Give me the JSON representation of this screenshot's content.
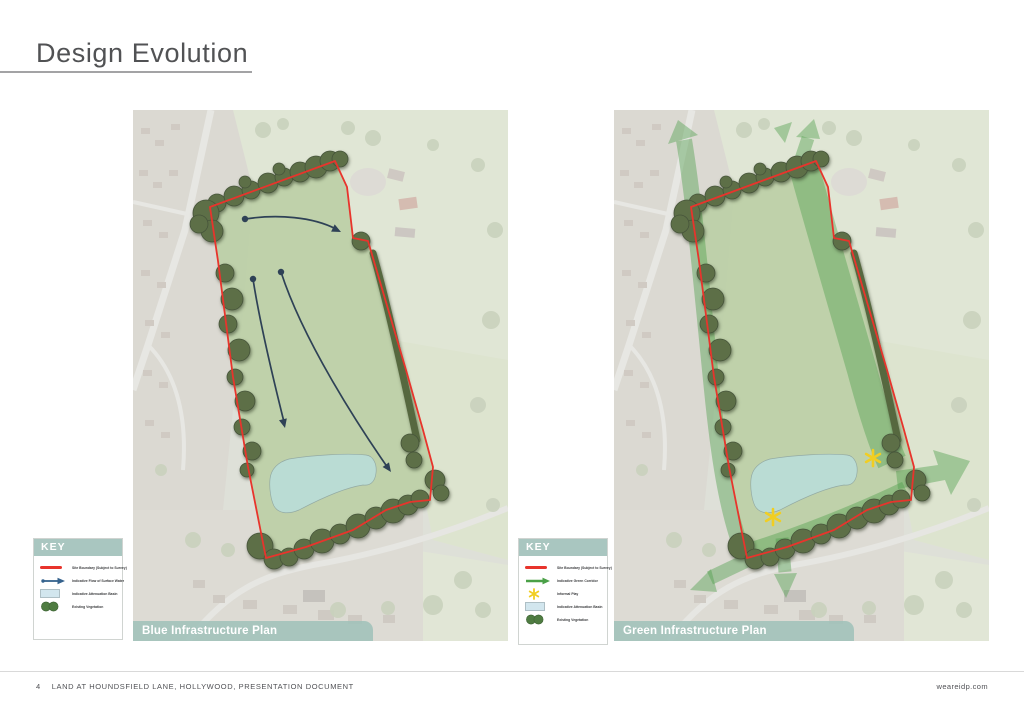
{
  "page": {
    "title": "Design Evolution",
    "footer": {
      "page_number": "4",
      "document_title": "LAND AT HOUNDSFIELD LANE, HOLLYWOOD, PRESENTATION DOCUMENT",
      "website": "weareidp.com"
    }
  },
  "plans": {
    "blue": {
      "caption": "Blue Infrastructure Plan",
      "legend": {
        "header": "KEY",
        "rows": [
          {
            "symbol": "site-boundary-line",
            "label": "Site Boundary (Subject to Survey)"
          },
          {
            "symbol": "surface-water-flow-arrow",
            "label": "Indicative Flow of Surface Water"
          },
          {
            "symbol": "attenuation-basin-swatch",
            "label": "Indicative Attenuation Basin"
          },
          {
            "symbol": "existing-vegetation-circles",
            "label": "Existing Vegetation"
          }
        ]
      }
    },
    "green": {
      "caption": "Green Infrastructure Plan",
      "legend": {
        "header": "KEY",
        "rows": [
          {
            "symbol": "site-boundary-line",
            "label": "Site Boundary (Subject to Survey)"
          },
          {
            "symbol": "green-corridor-arrow",
            "label": "Indicative Green Corridor"
          },
          {
            "symbol": "informal-play-star",
            "label": "Informal Play"
          },
          {
            "symbol": "attenuation-basin-swatch",
            "label": "Indicative Attenuation Basin"
          },
          {
            "symbol": "existing-vegetation-circles",
            "label": "Existing Vegetation"
          }
        ]
      }
    }
  },
  "colors": {
    "site_boundary_red": "#e8342c",
    "water_flow_navy": "#2e4156",
    "green_corridor_green": "#4c9d49",
    "attenuation_basin_blue": "#b9dcd6",
    "existing_vegetation_green": "#5d6f47",
    "informal_play_yellow": "#f1ce22",
    "key_header_teal": "#a9c6c0",
    "caption_band_teal": "#a0c1b9"
  }
}
